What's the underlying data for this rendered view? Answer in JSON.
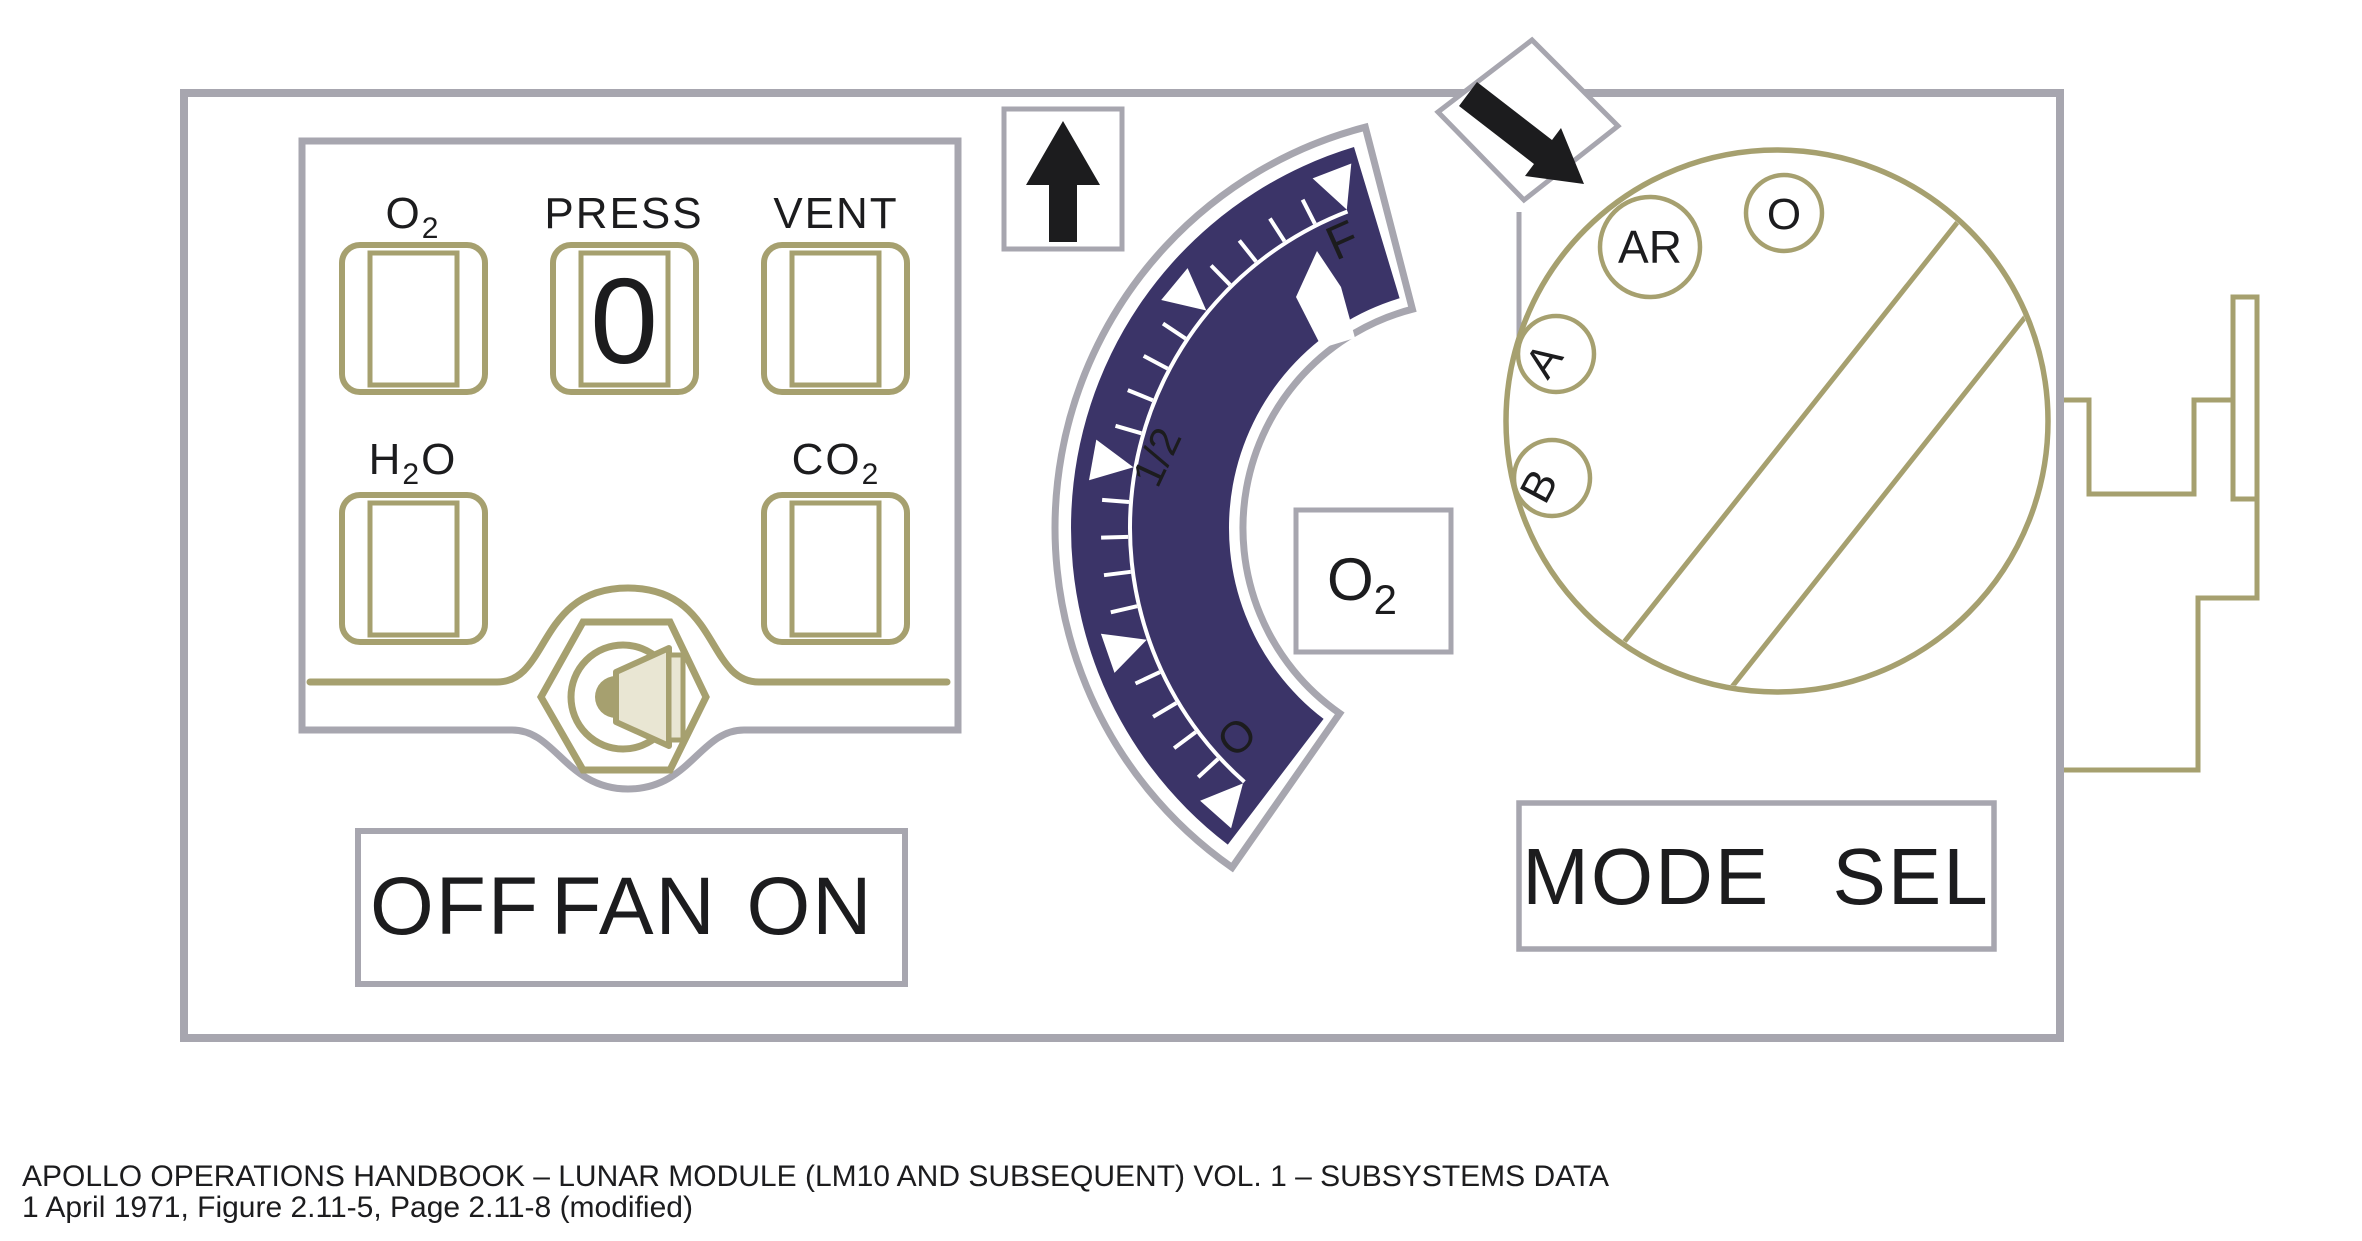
{
  "colors": {
    "panel_outline_gray": "#A7A6AF",
    "line_olive": "#A6A06F",
    "gauge_navy": "#3B3468",
    "indicator_green": "#2E7E4C",
    "ink_black": "#1C1C1E",
    "horn_cream": "#E9E6D3"
  },
  "quantity_panel": {
    "indicators": [
      {
        "id": "o2",
        "label_main": "O",
        "label_sub": "2",
        "label_post": "",
        "value": ""
      },
      {
        "id": "press",
        "label_main": "PRESS",
        "label_sub": "",
        "label_post": "",
        "value": "0"
      },
      {
        "id": "vent",
        "label_main": "VENT",
        "label_sub": "",
        "label_post": "",
        "value": ""
      },
      {
        "id": "h2o",
        "label_main": "H",
        "label_sub": "2",
        "label_post": "O",
        "value": ""
      },
      {
        "id": "co2",
        "label_main": "CO",
        "label_sub": "2",
        "label_post": "",
        "value": ""
      }
    ],
    "press_value": "0",
    "fan_switch": {
      "left": "OFF",
      "center": "FAN",
      "right": "ON"
    },
    "fan_icon": "speaker-horn-in-hex-nut"
  },
  "gauge": {
    "type": "curved-tape-gauge",
    "scale_labels": {
      "full": "F",
      "half": "1/2",
      "empty": "O"
    },
    "major_divisions": 4,
    "minor_ticks_per_division": 4,
    "needle_reading": "just below F",
    "tape_label": {
      "main": "O",
      "sub": "2"
    }
  },
  "mode_selector": {
    "label": "MODE SEL",
    "positions": [
      "AR",
      "O",
      "A",
      "B"
    ],
    "pointer_icon": "arrow-down-right"
  },
  "icons": {
    "up_arrow": "up-arrow",
    "pointer_arrow": "arrow-down-right",
    "fan": "speaker-horn"
  },
  "caption": {
    "line1": "APOLLO OPERATIONS HANDBOOK – LUNAR MODULE (LM10 AND SUBSEQUENT) VOL. 1 – SUBSYSTEMS DATA",
    "line2": "1 April 1971, Figure 2.11-5, Page 2.11-8 (modified)"
  }
}
